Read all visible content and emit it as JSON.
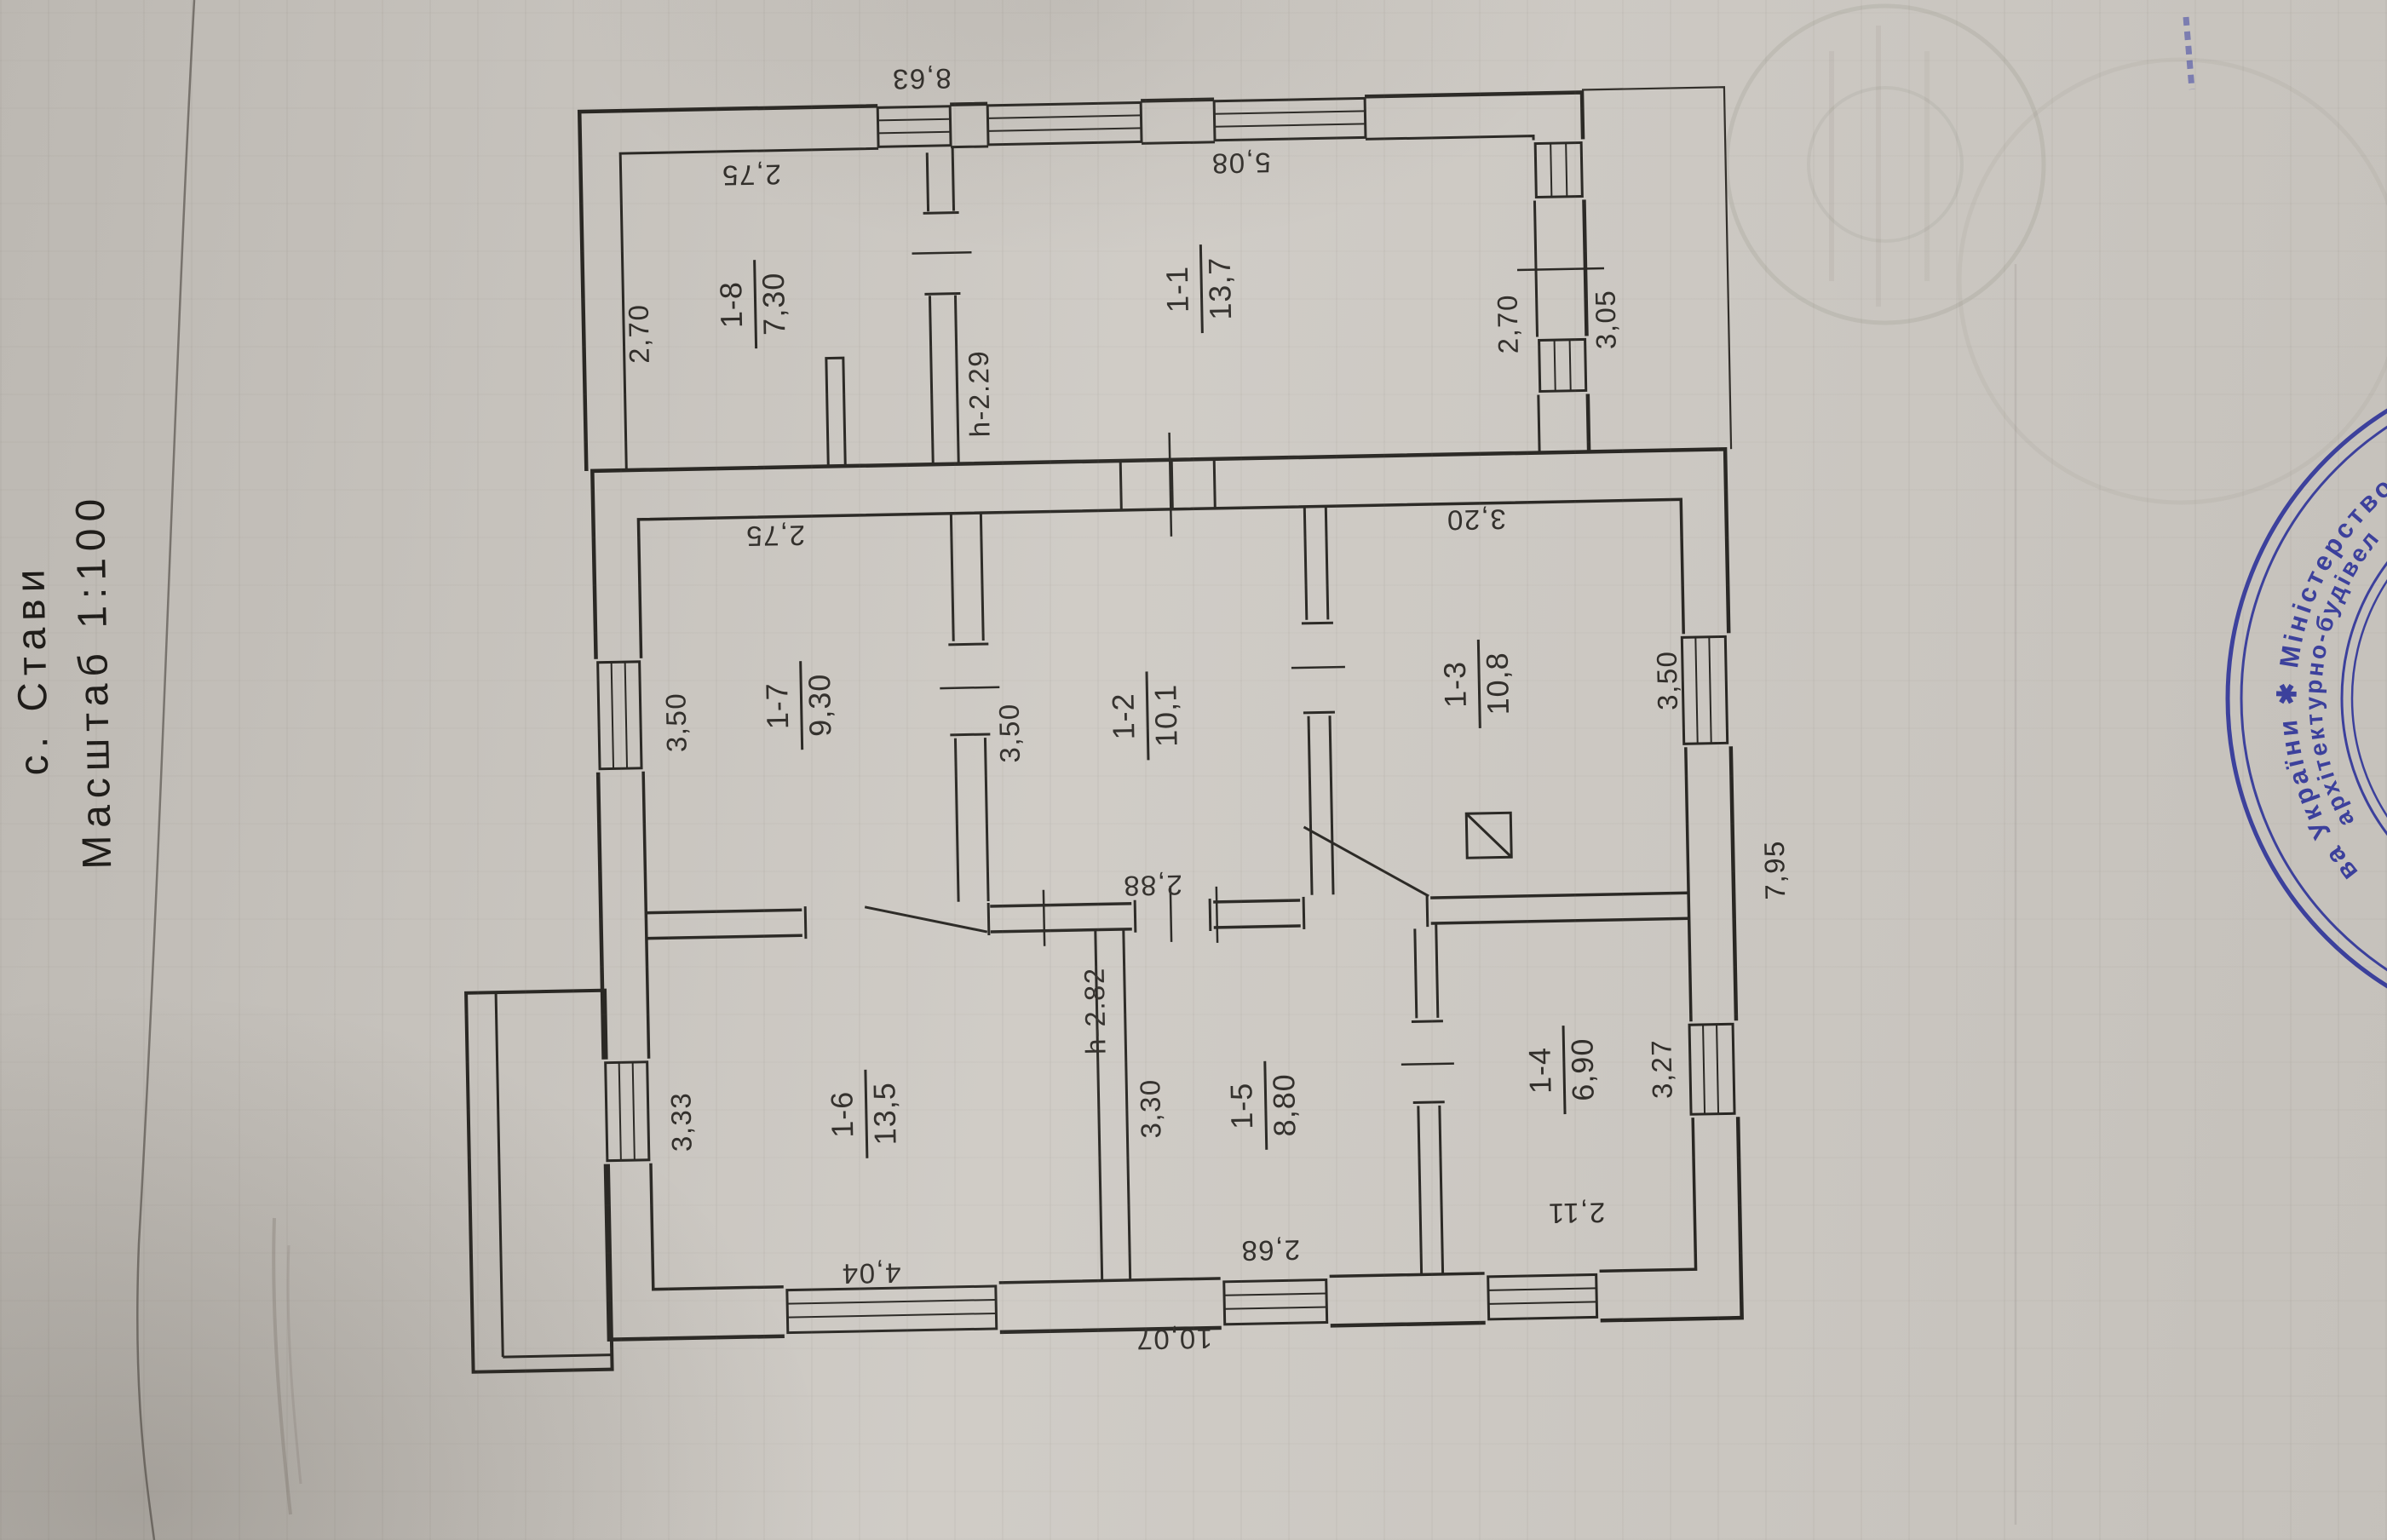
{
  "header": {
    "place": "с. Стави",
    "scale": "Масштаб 1:100"
  },
  "plan": {
    "rooms": [
      {
        "id": "1-1",
        "area": "13,7"
      },
      {
        "id": "1-2",
        "area": "10,1"
      },
      {
        "id": "1-3",
        "area": "10,8"
      },
      {
        "id": "1-4",
        "area": "6,90"
      },
      {
        "id": "1-5",
        "area": "8,80"
      },
      {
        "id": "1-6",
        "area": "13,5"
      },
      {
        "id": "1-7",
        "area": "9,30"
      },
      {
        "id": "1-8",
        "area": "7,30"
      }
    ],
    "dims": {
      "overall_top": "8,63",
      "overall_bottom": "10,07",
      "overall_right": "7,95",
      "r8_width": "2,75",
      "r8_depth": "2,70",
      "r1_width": "5,08",
      "r1_right_inner": "2,70",
      "r1_right_outer": "3,05",
      "porch_height": "h-2.29",
      "main_height": "h-2.82",
      "r7_width": "2,75",
      "r7_depth": "3,50",
      "r2_depth": "3,50",
      "r2_width": "2,88",
      "r3_width": "3,20",
      "r3_depth": "3,50",
      "r6_depth": "3,33",
      "r6_width": "4,04",
      "r5_depth": "3,30",
      "r5_width": "2,68",
      "r4_depth": "3,27",
      "r4_width": "2,11"
    }
  },
  "stamp": {
    "outer_arc": "ва України  ✱  Міністерство",
    "inner_arc": "архітектурно-будівел"
  }
}
